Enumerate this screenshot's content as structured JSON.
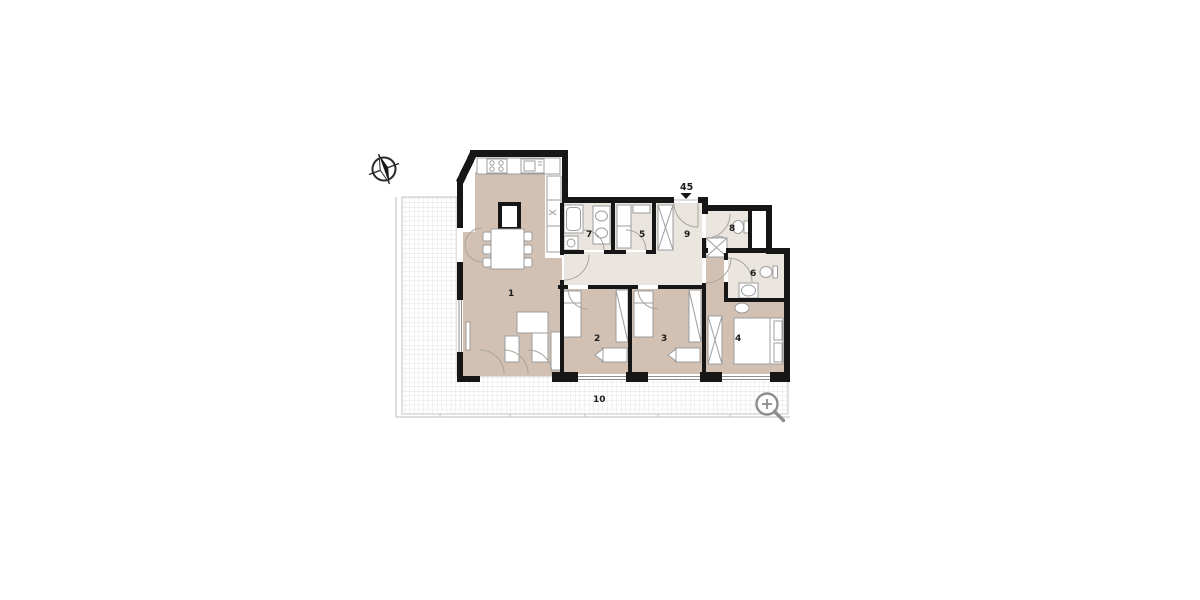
{
  "plan": {
    "entrance": {
      "label": "45"
    },
    "rooms": [
      {
        "number": "1"
      },
      {
        "number": "2"
      },
      {
        "number": "3"
      },
      {
        "number": "4"
      },
      {
        "number": "5"
      },
      {
        "number": "6"
      },
      {
        "number": "7"
      },
      {
        "number": "8"
      },
      {
        "number": "9"
      },
      {
        "number": "10"
      }
    ],
    "icons": {
      "compass": "compass-north-arrow",
      "magnifier": "zoom-in-magnifier"
    },
    "colors": {
      "wall": "#161616",
      "living_fill": "#d2c1b3",
      "service_fill": "#eae6df",
      "terrace_grid": "#e5e2dc",
      "terrace_border": "#c6c6c6",
      "furniture_line": "#9c9c9c",
      "door_arc": "#a8a49e",
      "icon_gray": "#8d8d8d"
    }
  }
}
